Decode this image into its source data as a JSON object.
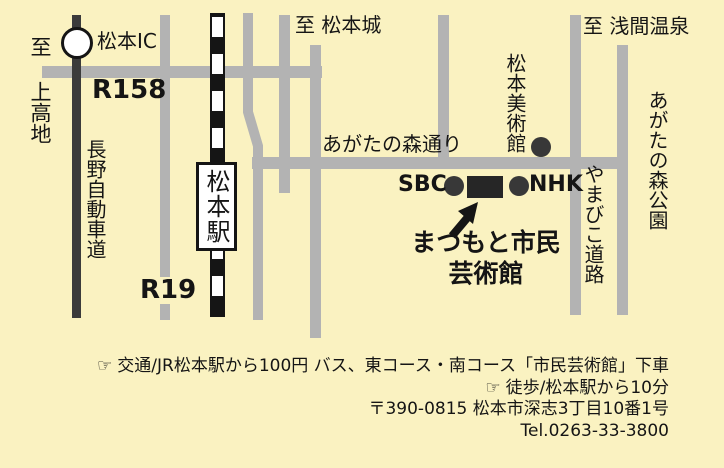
{
  "map": {
    "labels": {
      "to_kamikochi": "至 上高地",
      "matsumoto_ic": "松本IC",
      "route_158": "R158",
      "nagano_expressway": "長野自動車道",
      "matsumoto_station": "松本駅",
      "route_19": "R19",
      "to_matsumoto_castle": "至 松本城",
      "agatanomori_street": "あがたの森通り",
      "to_asama_onsen": "至 浅間温泉",
      "matsumoto_art_museum": "松本美術館",
      "agatanomori_park": "あがたの森公園",
      "yamabiko_road": "やまびこ道路",
      "sbc": "SBC",
      "nhk": "NHK",
      "venue_line1": "まつもと市民",
      "venue_line2": "芸術館"
    },
    "colors": {
      "background": "#FAF2C1",
      "road": "#B3B3B3",
      "expressway": "#3B3B3B",
      "railway": "#151515",
      "marker_dot": "#383838",
      "venue_block": "#262626"
    }
  },
  "footer": {
    "hand_icon": "☞",
    "access_bus": "交通/JR松本駅から100円 バス、東コース・南コース「市民芸術館」下車",
    "access_walk": "徒歩/松本駅から10分",
    "address": "〒390-0815 松本市深志3丁目10番1号",
    "tel": "Tel.0263-33-3800"
  }
}
